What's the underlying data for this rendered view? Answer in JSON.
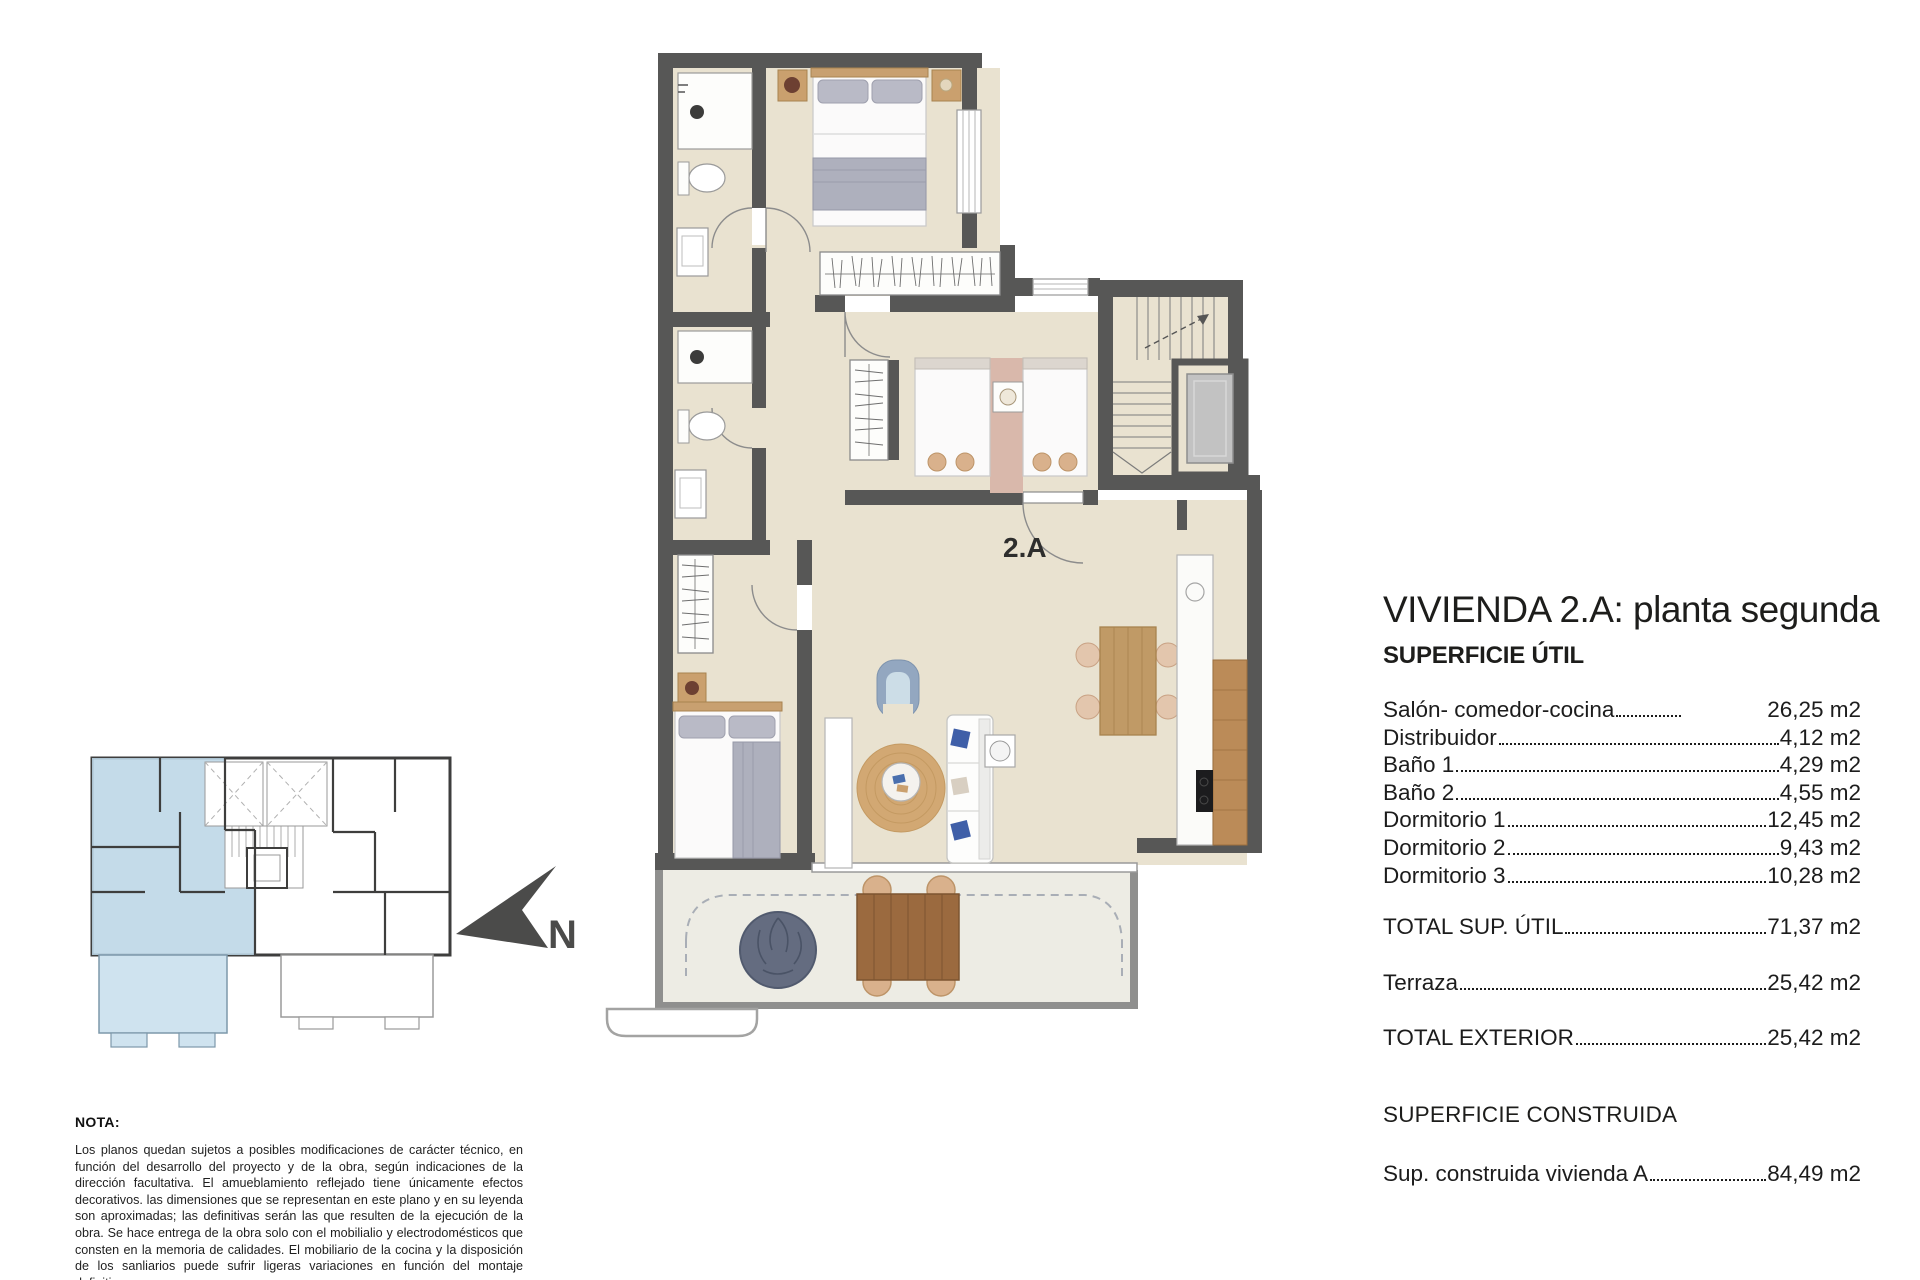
{
  "panel": {
    "title": "VIVIENDA 2.A: planta segunda",
    "section_util": "SUPERFICIE ÚTIL",
    "util_rows": [
      {
        "label": "Salón- comedor-cocina",
        "value": "26,25 m2"
      },
      {
        "label": "Distribuidor",
        "value": "4,12 m2"
      },
      {
        "label": "Baño 1",
        "value": "4,29 m2"
      },
      {
        "label": "Baño 2",
        "value": "4,55 m2"
      },
      {
        "label": "Dormitorio 1",
        "value": "12,45 m2"
      },
      {
        "label": "Dormitorio 2",
        "value": "9,43 m2"
      },
      {
        "label": "Dormitorio 3",
        "value": "10,28 m2"
      }
    ],
    "total_util": {
      "label": "TOTAL SUP. ÚTIL",
      "value": "71,37 m2"
    },
    "terraza": {
      "label": "Terraza",
      "value": "25,42 m2"
    },
    "total_exterior": {
      "label": "TOTAL EXTERIOR",
      "value": "25,42 m2"
    },
    "section_construida": "SUPERFICIE CONSTRUIDA",
    "construida": {
      "label": "Sup. construida vivienda A",
      "value": "84,49 m2"
    }
  },
  "plan": {
    "unit_label": "2.A"
  },
  "north": {
    "label": "N"
  },
  "note": {
    "heading": "NOTA:",
    "body": "Los planos quedan sujetos a posibles modificaciones de carácter técnico, en función del desarrollo del proyecto y de la obra, según indicaciones de la dirección facultativa. El amueblamiento reflejado tiene únicamente efectos decorativos. las dimensiones que se representan en este plano y en su leyenda son aproximadas; las definitivas serán las que resulten de la ejecución de la obra. Se hace entrega de la obra solo con el mobilialio y electrodomésticos que consten en la memoria de calidades. El mobiliario de la cocina y la disposición de los sanliarios puede sufrir ligeras variaciones en función del montaje definitivo."
  },
  "colors": {
    "wall": "#575756",
    "floor": "#e9e2d0",
    "terrace_floor": "#edece4",
    "unit_highlight": "#bcd6e6",
    "text": "#1d1d1b"
  }
}
